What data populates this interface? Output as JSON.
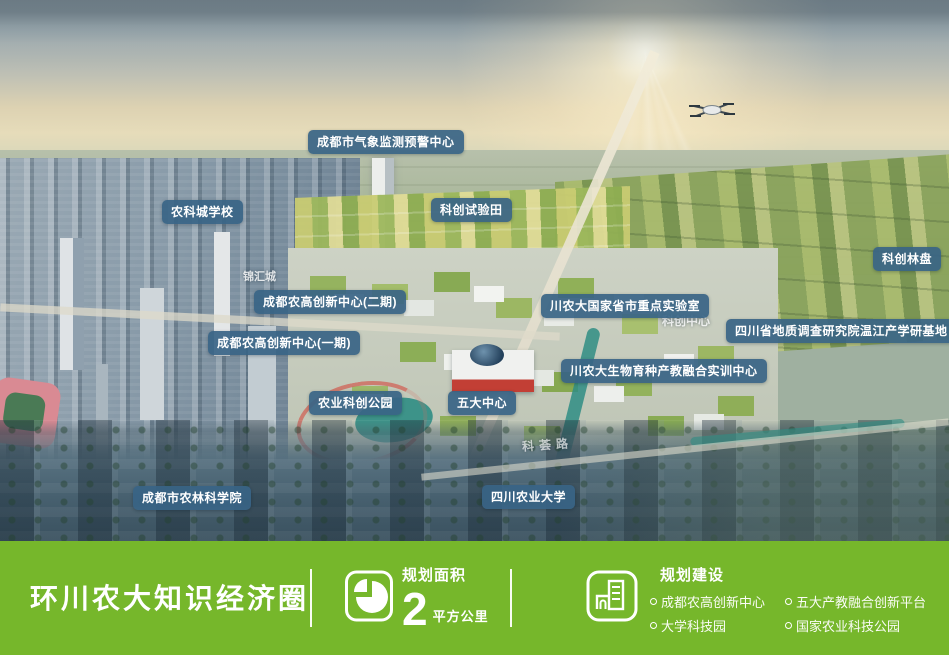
{
  "overlay": {
    "labels": [
      {
        "id": "weather-center",
        "text": "成都市气象监测预警中心"
      },
      {
        "id": "nongke-school",
        "text": "农科城学校"
      },
      {
        "id": "trial-fields",
        "text": "科创试验田"
      },
      {
        "id": "linpan",
        "text": "科创林盘"
      },
      {
        "id": "agri-hitech-phase2",
        "text": "成都农高创新中心(二期)"
      },
      {
        "id": "key-lab",
        "text": "川农大国家省市重点实验室"
      },
      {
        "id": "geology-base",
        "text": "四川省地质调查研究院温江产学研基地"
      },
      {
        "id": "agri-hitech-phase1",
        "text": "成都农高创新中心(一期)"
      },
      {
        "id": "breeding-center",
        "text": "川农大生物育种产教融合实训中心"
      },
      {
        "id": "agri-sci-park",
        "text": "农业科创公园"
      },
      {
        "id": "five-centers",
        "text": "五大中心"
      },
      {
        "id": "forestry-academy",
        "text": "成都市农林科学院"
      },
      {
        "id": "sichuan-agri-university",
        "text": "四川农业大学"
      }
    ],
    "ghost_labels": [
      {
        "id": "jinhuicheng",
        "text": "锦汇城"
      },
      {
        "id": "kechuang-center",
        "text": "科创中心"
      },
      {
        "id": "kehui-road",
        "text": "科荟路"
      }
    ]
  },
  "footer": {
    "title": "环川农大知识经济圈",
    "area": {
      "icon": "pie-chart-icon",
      "label": "规划面积",
      "value": "2",
      "unit": "平方公里"
    },
    "construction": {
      "icon": "building-icon",
      "label": "规划建设",
      "items": [
        "成都农高创新中心",
        "五大产教融合创新平台",
        "大学科技园",
        "国家农业科技公园"
      ]
    }
  },
  "colors": {
    "footer_green": "#76b72b",
    "label_pill_blue": "#386486",
    "water_teal": "#2f8d84",
    "text_white": "#ffffff"
  }
}
